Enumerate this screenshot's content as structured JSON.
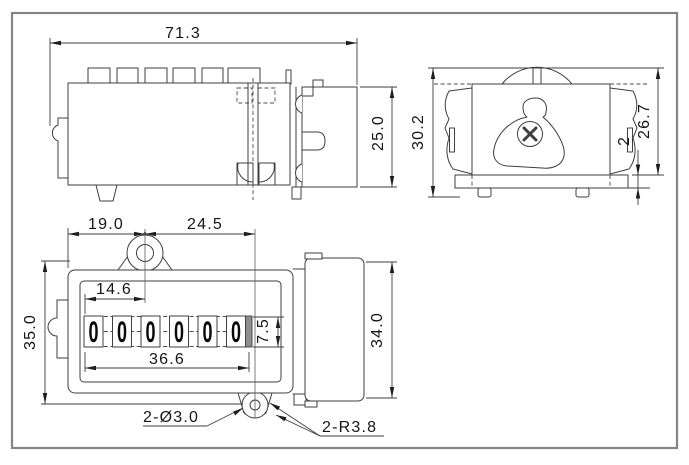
{
  "drawing": {
    "dims": {
      "top_width": "71.3",
      "top_depth": "25.0",
      "side_total_height": "30.2",
      "side_body_height": "26.7",
      "side_base_thickness": "2",
      "front_ear_offset": "19.0",
      "front_ear_span": "24.5",
      "front_window_offset": "14.6",
      "front_height": "35.0",
      "front_window_width": "36.6",
      "front_window_height": "7.5",
      "front_rear_height": "34.0"
    },
    "callouts": {
      "holes": "2-Ø3.0",
      "radius": "2-R3.8"
    },
    "counter": {
      "digits": [
        "0",
        "0",
        "0",
        "0",
        "0",
        "0"
      ]
    }
  }
}
